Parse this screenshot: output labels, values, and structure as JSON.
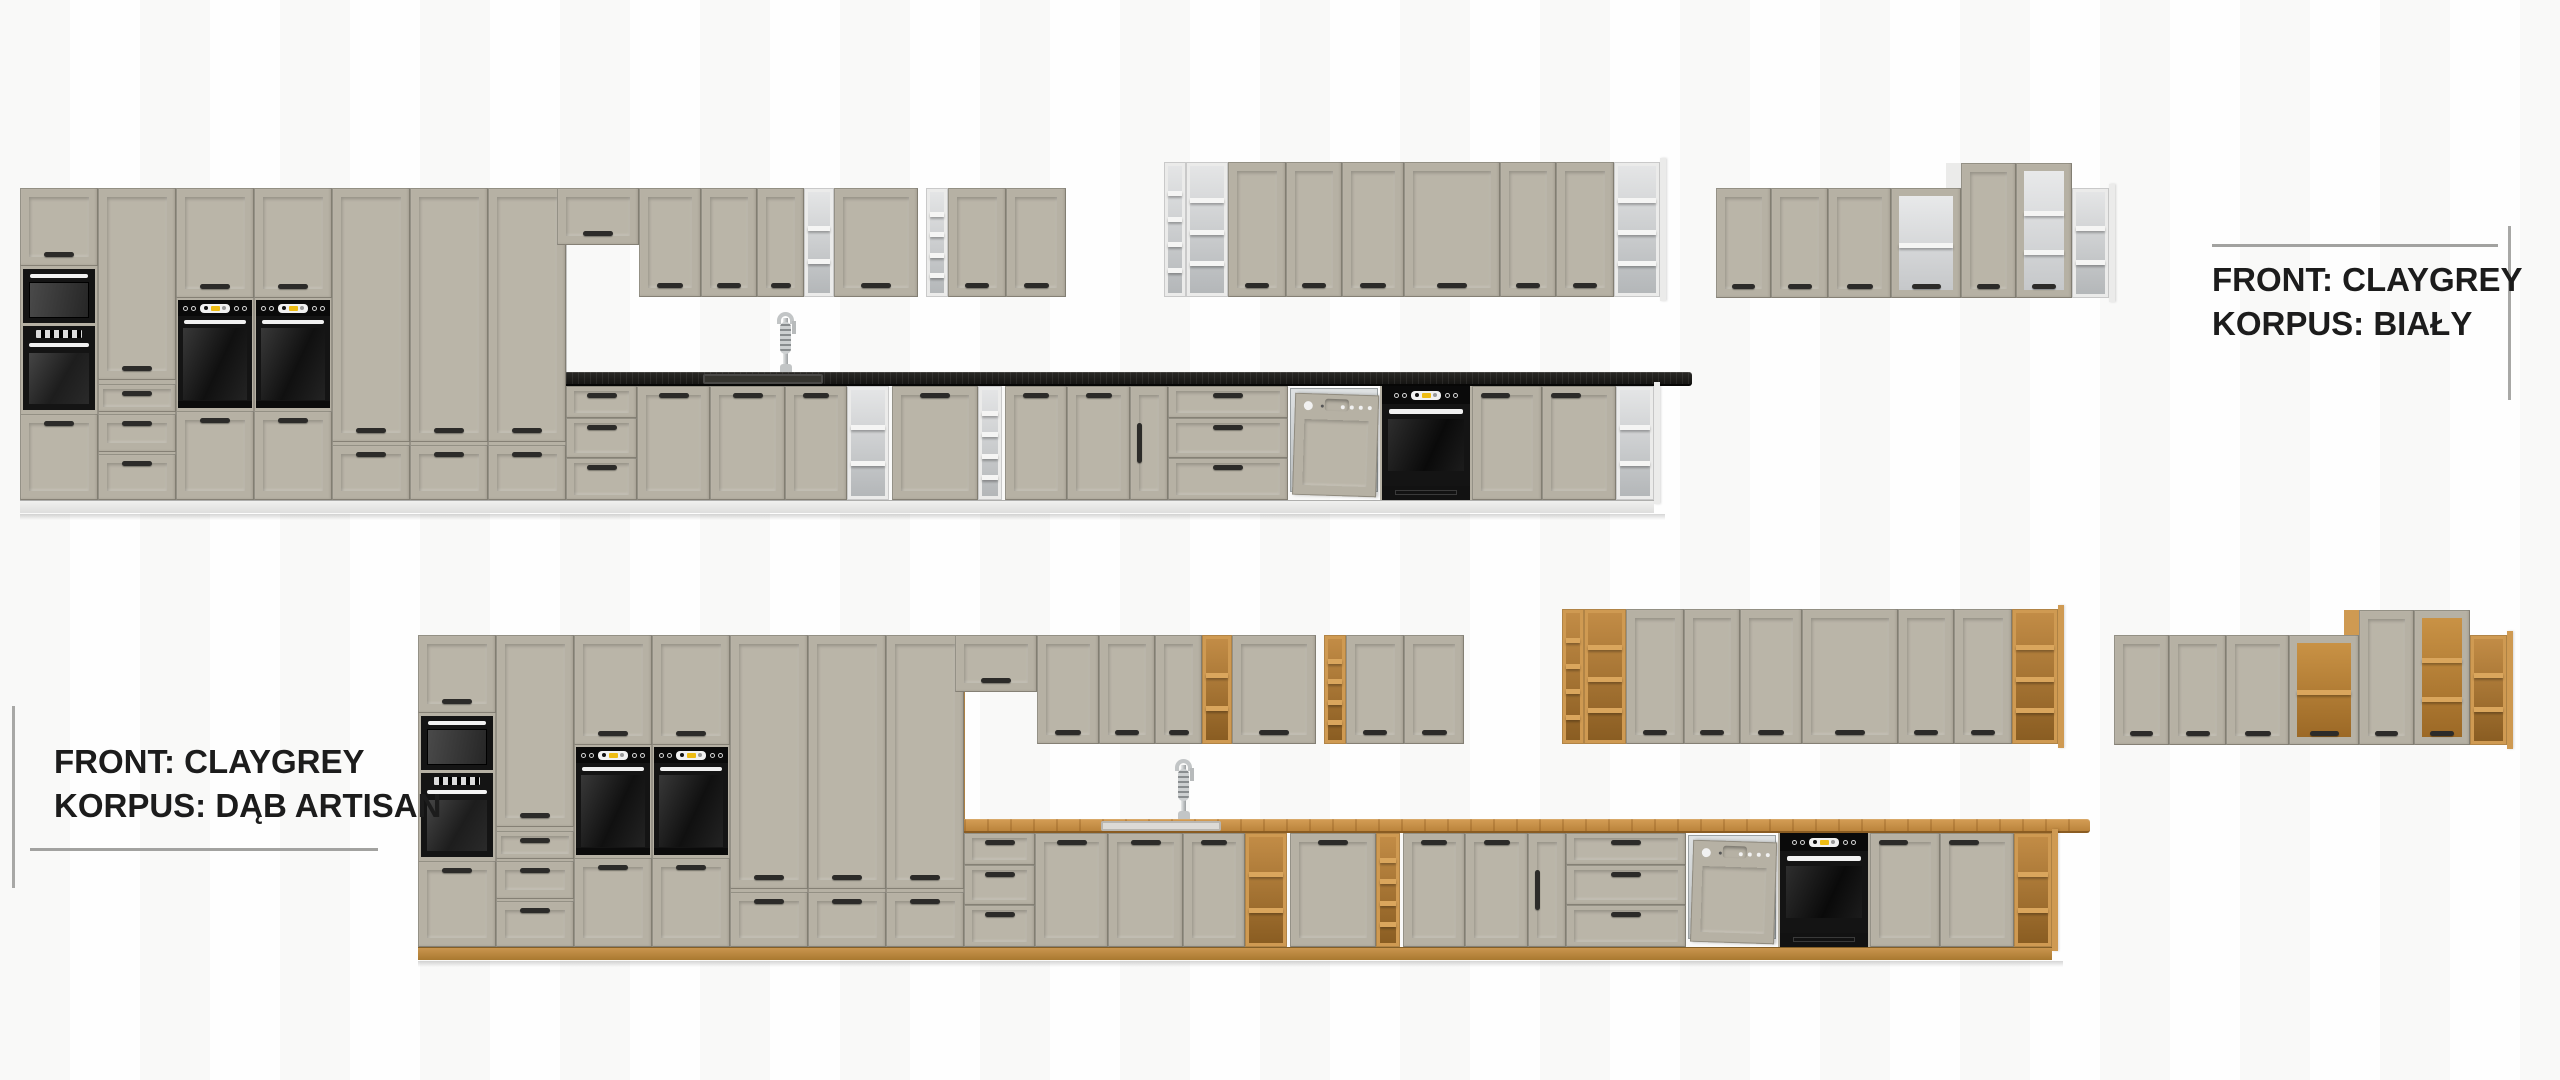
{
  "meta": {
    "type": "product-visualization",
    "subject": "Modular kitchen cabinet set with CLAYGREY fronts shown in two carcass colour variants",
    "rows": 2
  },
  "variants": [
    {
      "id": "bialy",
      "front_line": "FRONT: CLAYGREY",
      "korpus_line": "KORPUS: BIAŁY",
      "front_colour_name": "CLAYGREY",
      "korpus_colour_name": "BIAŁY",
      "label_position": "top-right"
    },
    {
      "id": "dab-artisan",
      "front_line": "FRONT: CLAYGREY",
      "korpus_line": "KORPUS: DĄB ARTISAN",
      "front_colour_name": "CLAYGREY",
      "korpus_colour_name": "DĄB ARTISAN",
      "label_position": "bottom-left"
    }
  ],
  "scene": {
    "appliances": [
      "microwave-oven",
      "built-in-oven-column",
      "two-built-in-ovens-in-tall-housings",
      "dishwasher-with-furniture-panel",
      "under-counter-black-oven"
    ],
    "features": [
      "tall-cabinet-block",
      "wall-cabinet-run",
      "open-shelf-units",
      "wine-rack-units",
      "glass-display-cabinets",
      "corner-open-shelves",
      "sink-with-tall-spring-faucet",
      "black-worktop-on-bialy-variant",
      "oak-worktop-on-dab-artisan-variant"
    ]
  },
  "colors": {
    "front": "#b6b1a4",
    "front_panel": "#bab5a8",
    "front_edge": "#8f8b7d",
    "handle": "#2c2b29",
    "appliance_black": "#141414",
    "appliance_window": "#2e2e2e",
    "accent_yellow": "#eebc13",
    "appliance_white": "#f1f1f1",
    "steel": "#c6c9ca",
    "text": "#1c1c1c",
    "rule_line": "#a2a2a0",
    "background_stripe": "#f7f7f5",
    "variant_top": {
      "carcass": "#ebebea",
      "carcass_shade": "#d2d3d3",
      "open_a": "#e4e5e6",
      "open_b": "#b4b7b9",
      "shelf": "#f5f5f4",
      "glass_a": "#e8e9ea",
      "glass_b": "#c6c8ca",
      "counter_a": "#2a2926",
      "counter_b": "#161513",
      "counter_edge": "#070706",
      "plinth_a": "#f0f0ef",
      "plinth_b": "#dededd",
      "sink_border": "#4a4947",
      "sink_fill": "#35342f"
    },
    "variant_bottom": {
      "carcass": "#cf9a52",
      "carcass_shade": "#a87433",
      "open_a": "#c28c46",
      "open_b": "#8a5d22",
      "shelf": "#daa65d",
      "glass_a": "#c99245",
      "glass_b": "#9c6926",
      "counter_a": "#d49d55",
      "counter_b": "#bb843c",
      "counter_edge": "#8a5c22",
      "plinth_a": "#ca954e",
      "plinth_b": "#a97930",
      "sink_border": "#b9b6b0",
      "sink_fill": "#dcdad6"
    }
  }
}
